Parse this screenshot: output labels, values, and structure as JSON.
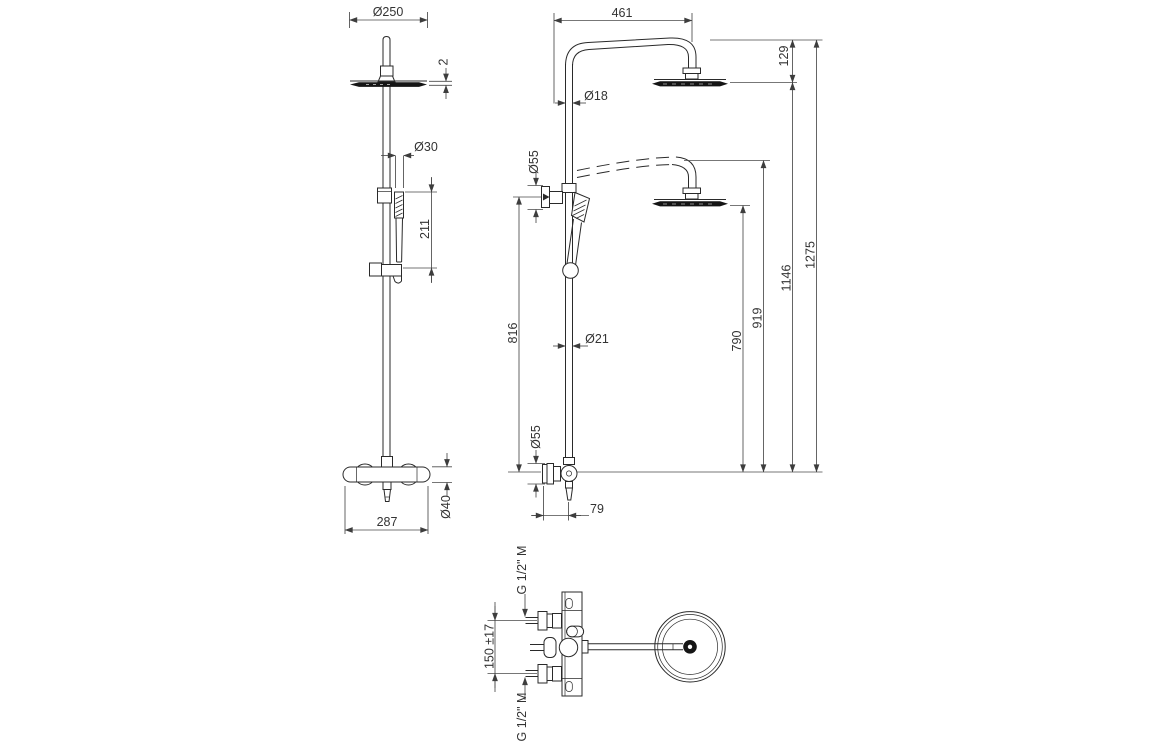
{
  "front_view": {
    "head_diameter": "Ø250",
    "head_thickness": "2",
    "handshower_diameter": "Ø30",
    "handshower_length": "211",
    "valve_width": "287",
    "valve_body_diameter": "Ø40"
  },
  "side_view": {
    "arm_reach": "461",
    "head_drop": "129",
    "upper_pipe_diameter": "Ø18",
    "bracket_diameter": "Ø55",
    "bracket_height": "816",
    "riser_diameter": "Ø21",
    "valve_trim_diameter": "Ø55",
    "wall_offset": "79",
    "head_height_lowered": "790",
    "arm_height_lowered": "919",
    "head_height_raised": "1146",
    "overall_height": "1275"
  },
  "top_view": {
    "inlet_spacing": "150 ±17",
    "inlet_thread_top": "G 1/2\" M",
    "inlet_thread_bottom": "G 1/2\" M"
  }
}
